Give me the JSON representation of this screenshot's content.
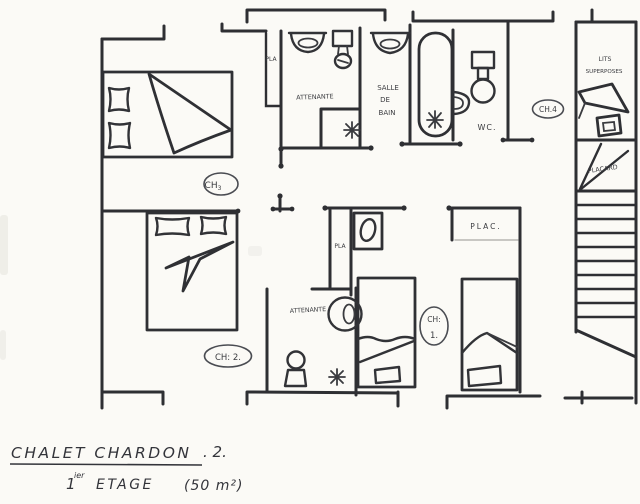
{
  "labels": {
    "pla_top": "PLA",
    "attenante_top": "ATTENANTE",
    "salle_1": "SALLE",
    "salle_2": "DE",
    "salle_3": "BAIN",
    "wc": "WC.",
    "ch4": "CH.4",
    "lits_1": "LITS",
    "lits_2": "SUPERPOSES",
    "placard": "PLACARD",
    "ch3_main": "CH",
    "ch3_sub": "3",
    "pla_mid": "PLA",
    "plac": "PLAC.",
    "attenante_low": "ATTENANTE",
    "ch1_a": "CH:",
    "ch1_b": "1.",
    "ch2": "CH: 2."
  },
  "title": {
    "main": "CHALET CHARDON",
    "suffix": ". 2.",
    "floor_num": "1",
    "floor_sup": "ier",
    "floor_word": "ETAGE",
    "area": "(50 m²)"
  },
  "colors": {
    "ink": "#2e2f33",
    "paper": "#fbfaf6"
  }
}
